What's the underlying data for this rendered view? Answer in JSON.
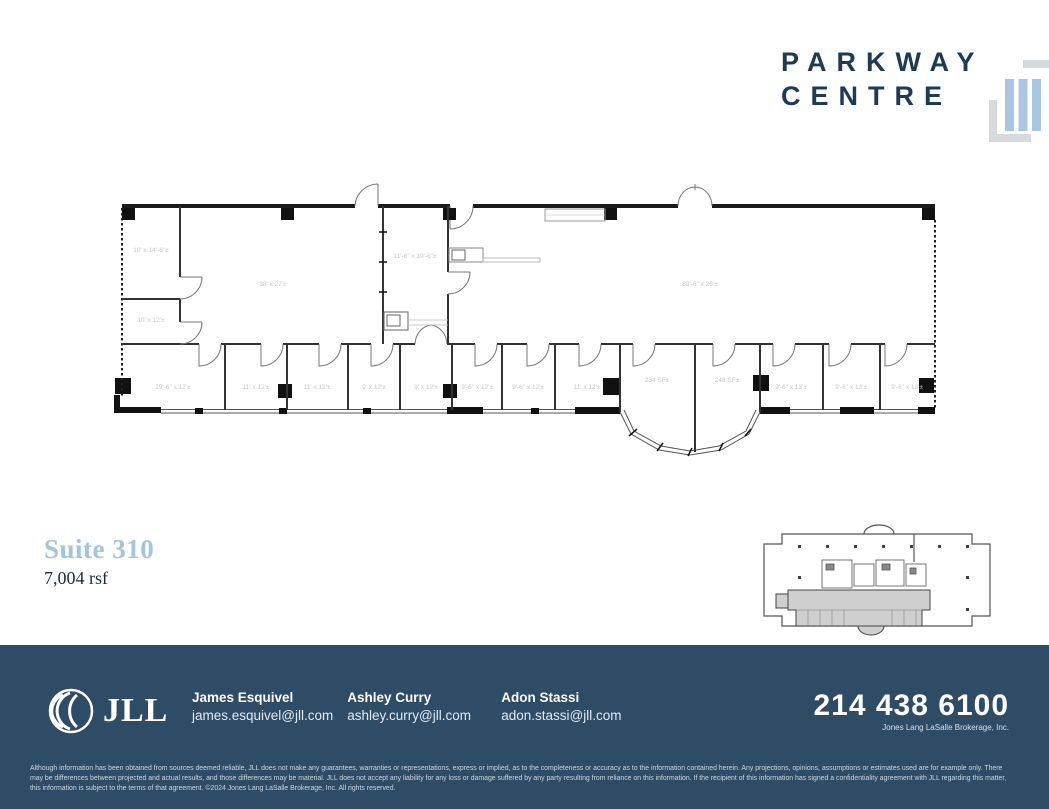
{
  "brand": {
    "line1": "PARKWAY",
    "line2": "CENTRE",
    "numeral": "III"
  },
  "suite": {
    "title": "Suite 310",
    "area": "7,004 rsf"
  },
  "floorplan": {
    "rooms": [
      {
        "label": "10' x 14'-6\"±"
      },
      {
        "label": "10' x 12'±"
      },
      {
        "label": "38' x 27'±"
      },
      {
        "label": "11'-6\" x 19'-6\"±"
      },
      {
        "label": "89'-6\" x 26'±"
      },
      {
        "label": "19'-6\" x 12'±"
      },
      {
        "label": "11' x 12'±"
      },
      {
        "label": "11' x 12'±"
      },
      {
        "label": "9' x 12'±"
      },
      {
        "label": "9' x 12'±"
      },
      {
        "label": "9'-6\" x 12'±"
      },
      {
        "label": "9'-6\" x 12'±"
      },
      {
        "label": "11' x 12'±"
      },
      {
        "label": "234 SF±"
      },
      {
        "label": "248 SF±"
      },
      {
        "label": "9'-6\" x 13'±"
      },
      {
        "label": "9'-6\" x 13'±"
      },
      {
        "label": "9'-6\" x 13'±"
      }
    ]
  },
  "footer": {
    "logo_text": "JLL",
    "contacts": [
      {
        "name": "James Esquivel",
        "email": "james.esquivel@jll.com"
      },
      {
        "name": "Ashley Curry",
        "email": "ashley.curry@jll.com"
      },
      {
        "name": "Adon Stassi",
        "email": "adon.stassi@jll.com"
      }
    ],
    "phone": "214 438 6100",
    "company": "Jones Lang LaSalle Brokerage, Inc.",
    "disclaimer": "Although information has been obtained from sources deemed reliable, JLL does not make any guarantees, warranties or representations, express or implied, as to the completeness or accuracy as to the information contained herein. Any projections, opinions, assumptions or estimates used are for example only. There may be differences between projected and actual results, and those differences may be material. JLL does not accept any liability for any loss or damage suffered by any party resulting from reliance on this information. If the recipient of this information has signed a confidentiality agreement with JLL regarding this matter, this information is subject to the terms of that agreement. ©2024 Jones Lang LaSalle Brokerage, Inc. All rights reserved."
  },
  "colors": {
    "navy": "#1d3a57",
    "light_blue": "#a9c7e2",
    "footer_bg": "#2e4c66",
    "plan_label": "#c6c6c6"
  }
}
